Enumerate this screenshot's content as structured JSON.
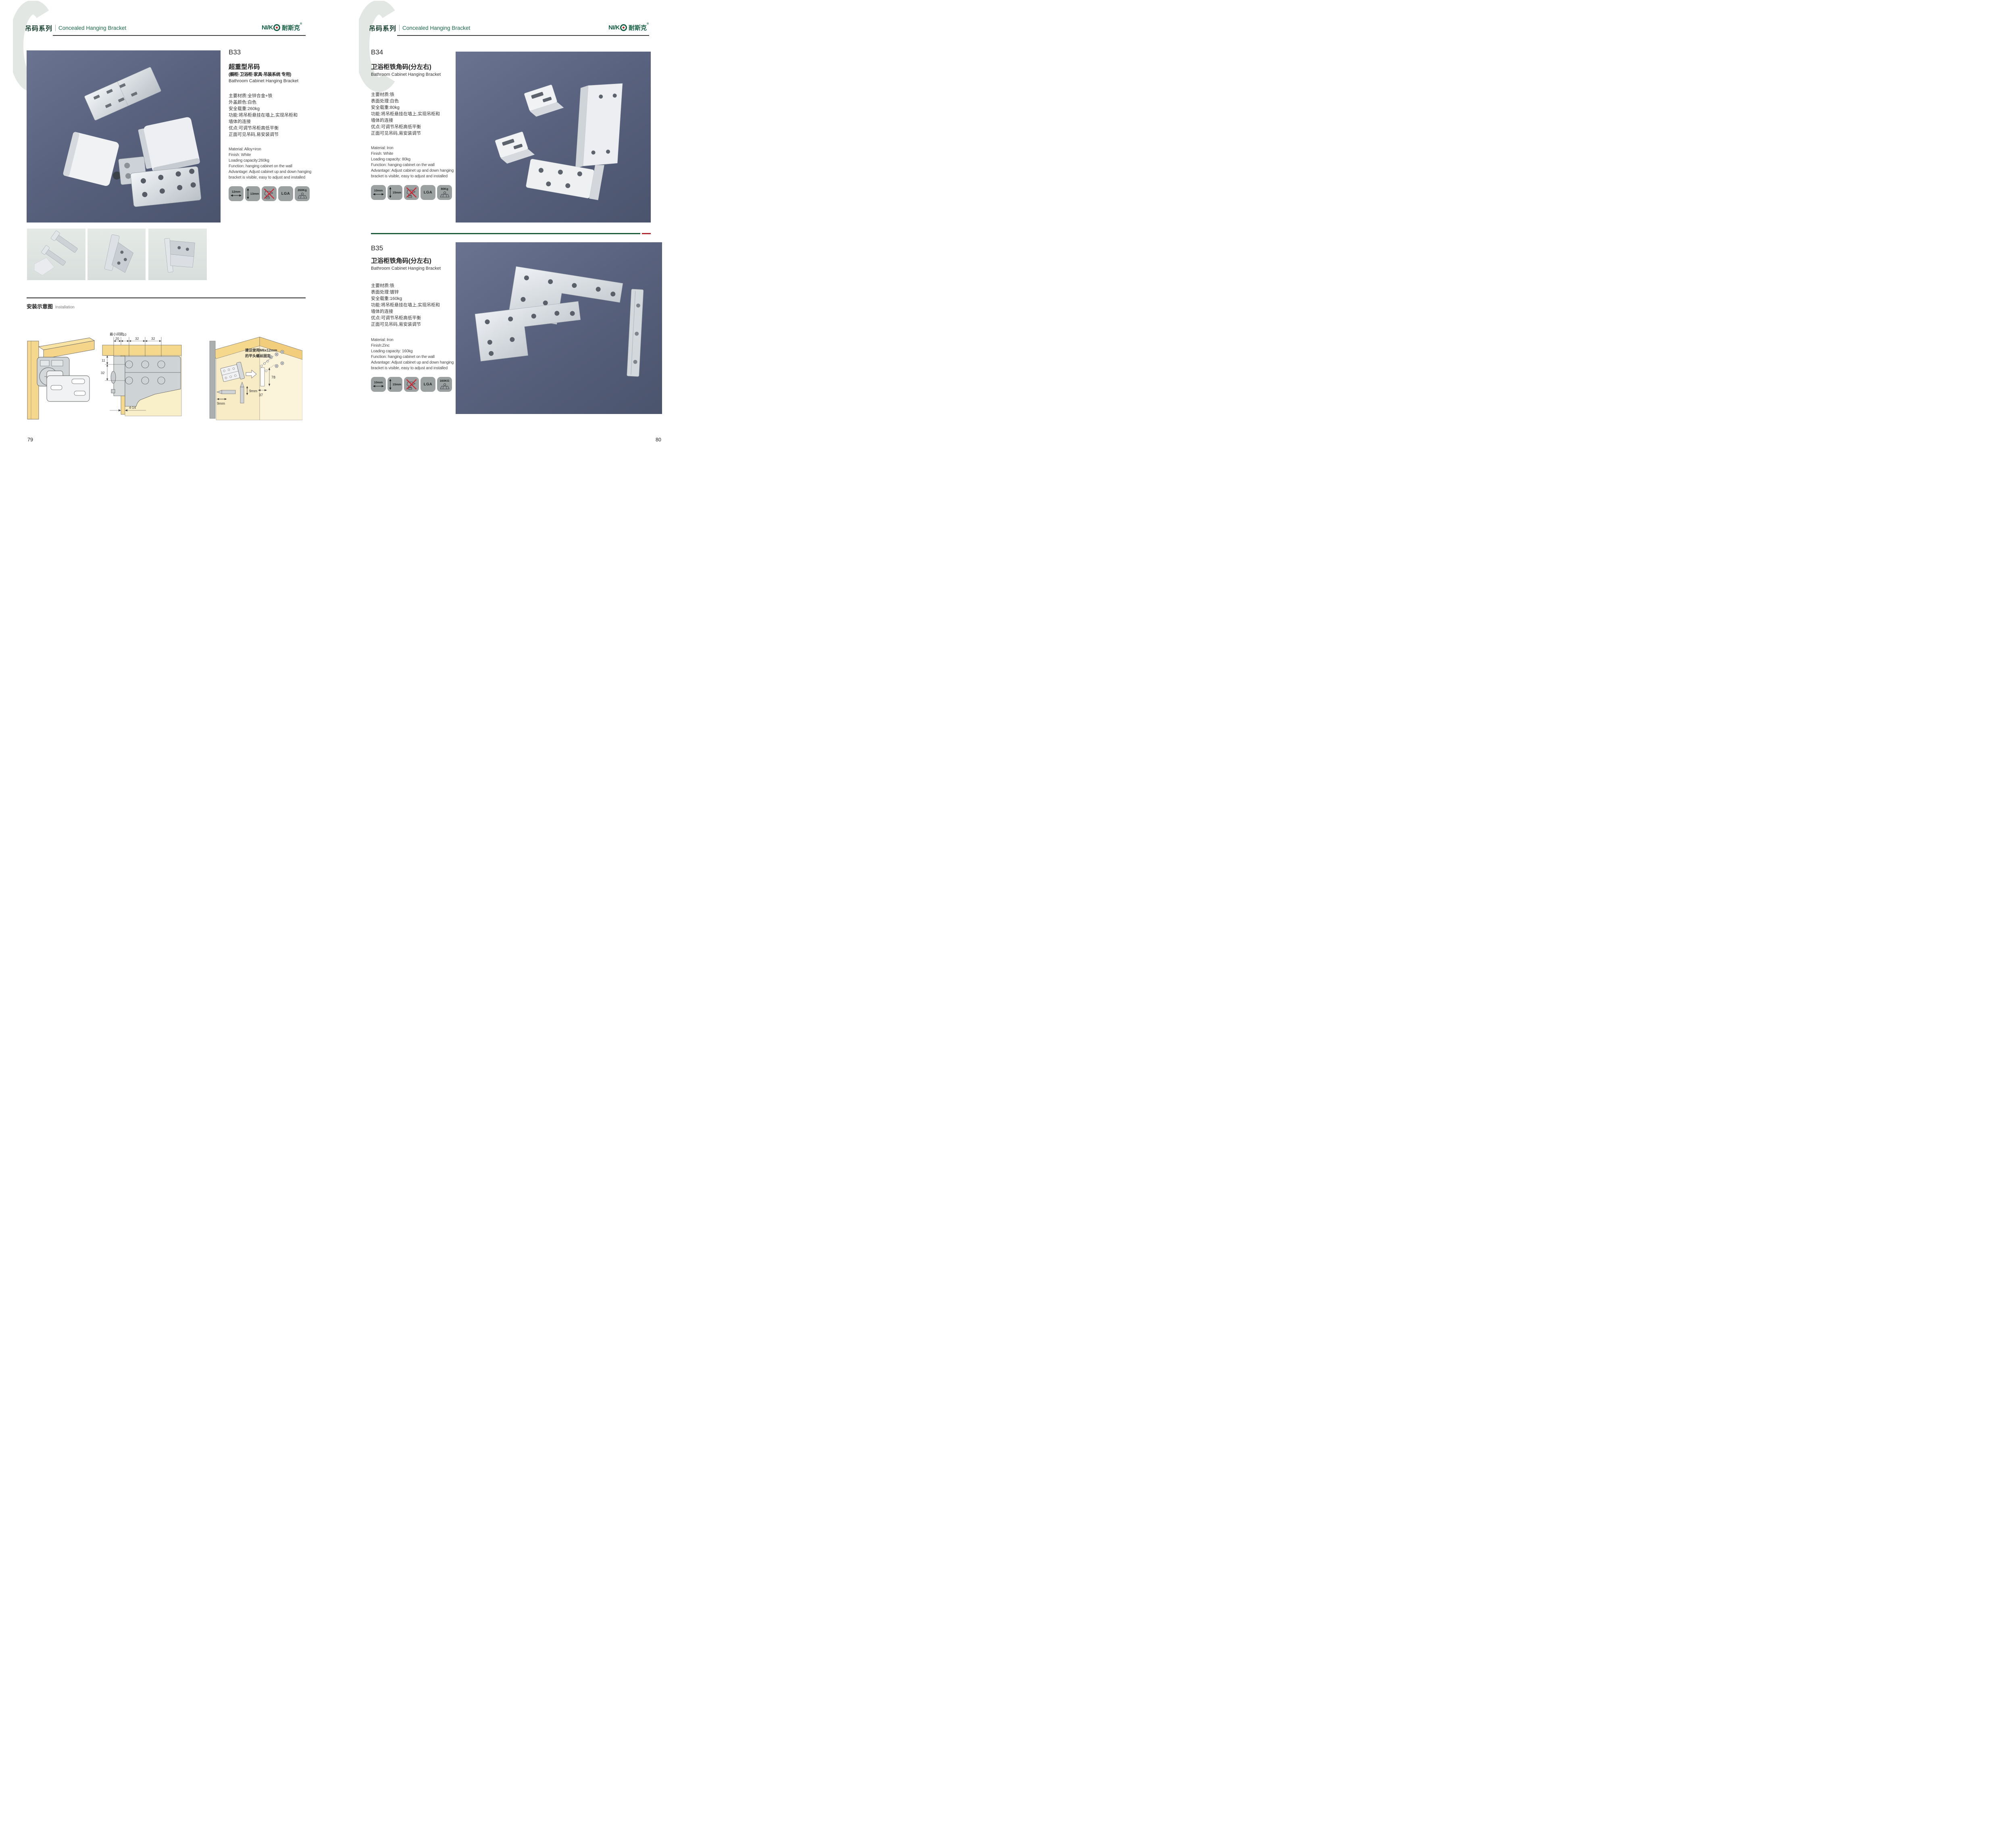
{
  "header": {
    "series_cn": "吊码系列",
    "series_en": "Concealed Hanging Bracket"
  },
  "logo": {
    "latin": "NI/K",
    "cn": "耐斯克",
    "reg": "®"
  },
  "colors": {
    "accent_green": "#166044",
    "header_text_green": "#1a6b4a",
    "logo_red": "#c61f26",
    "photo_background": "#59627e",
    "badge_background": "#9ba1a1",
    "divider_green": "#1c5a39",
    "divider_red": "#b1272c",
    "wood_yellow": "#f6d88c",
    "panel_yellow": "#f9efc9"
  },
  "left": {
    "page_number": "79",
    "product": {
      "code": "B33",
      "title_cn": "超重型吊码",
      "subtitle_cn": "(橱柜·卫浴柜·家具·吊装系统 专用)",
      "title_en": "Bathroom Cabinet Hanging Bracket",
      "specs_cn": [
        "主要材质:全锌合金+铁",
        "外盖颜色:白色",
        "安全载重:260kg",
        "功能:将吊柜悬挂在墙上,实现吊柜和",
        "墙体的连接",
        "优点:可调节吊柜高低平衡",
        "正面可见吊码,易安装调节"
      ],
      "specs_en": [
        "Material: Alloy+iron",
        "Finish: White",
        "Loading capacity:260kg",
        "Function: hanging cabinet on the wall",
        "Advantage: Adjust cabinet up and down hanging",
        "bracket is visible, easy to adjust and installed"
      ],
      "badges": {
        "width": "12mm",
        "height": "13mm",
        "cert": "LGA",
        "weight": "260Kg"
      }
    },
    "installation": {
      "title_cn": "安装示意图",
      "title_en": "Installation",
      "cross_section": {
        "min_label": "最小间距",
        "d20": "20",
        "d10": "10",
        "d32a": "32",
        "d32b": "32",
        "d11": "11",
        "d32c": "32",
        "d414": "4-14"
      },
      "corner": {
        "note1": "建议使用M6x12mm",
        "note2": "的平头螺丝固定",
        "d78": "78",
        "d37": "37",
        "d9a": "9mm",
        "d9b": "9mm"
      }
    }
  },
  "right": {
    "page_number": "80",
    "b34": {
      "code": "B34",
      "title_cn": "卫浴柜铁角码(分左右)",
      "title_en": "Bathroom Cabinet Hanging Bracket",
      "specs_cn": [
        "主要材质:铁",
        "表面处理:白色",
        "安全载重:80kg",
        "功能:将吊柜悬挂在墙上,实现吊柜和",
        "墙体的连接",
        "优点:可调节吊柜高低平衡",
        "正面可见吊码,易安装调节"
      ],
      "specs_en": [
        "Material: Iron",
        "Finish: White",
        "Loading capacity: 80kg",
        "Function: hanging cabinet on the wall",
        "Advantage: Adjust cabinet up and down hanging",
        "bracket is visible, easy to adjust and installed"
      ],
      "badges": {
        "width": "10mm",
        "height": "15mm",
        "cert": "LGA",
        "weight": "80Kg"
      }
    },
    "b35": {
      "code": "B35",
      "title_cn": "卫浴柜铁角码(分左右)",
      "title_en": "Bathroom Cabinet Hanging Bracket",
      "specs_cn": [
        "主要材质:铁",
        "表面处理:镀锌",
        "安全载重:160kg",
        "功能:将吊柜悬挂在墙上,实现吊柜和",
        "墙体的连接",
        "优点:可调节吊柜高低平衡",
        "正面可见吊码,易安装调节"
      ],
      "specs_en": [
        "Material: Iron",
        "Finish:Zinc",
        "Loading capacity: 160kg",
        "Function: hanging cabinet on the wall",
        "Advantage: Adjust cabinet up and down hanging",
        "bracket is visible, easy to adjust and installed"
      ],
      "badges": {
        "width": "10mm",
        "height": "15mm",
        "cert": "LGA",
        "weight": "160KG"
      }
    }
  }
}
